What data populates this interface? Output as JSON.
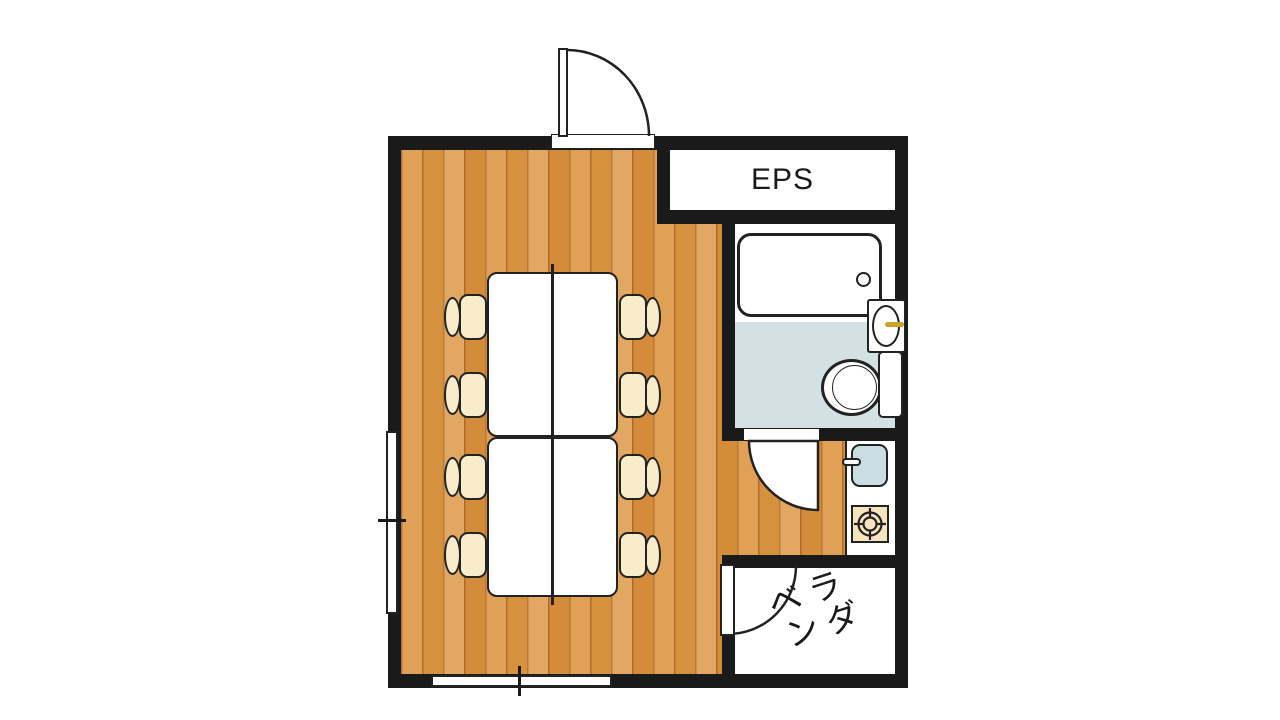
{
  "floorplan": {
    "title": "room-floor-plan",
    "labels": {
      "eps": "EPS",
      "veranda_line1": "ベラ",
      "veranda_line2": "ンダ"
    },
    "rooms": [
      {
        "name": "main-room",
        "floor": "wood"
      },
      {
        "name": "eps-shaft",
        "floor": "white"
      },
      {
        "name": "bathroom",
        "floor": "light-blue"
      },
      {
        "name": "kitchen-hallway",
        "floor": "wood"
      },
      {
        "name": "veranda",
        "floor": "white"
      }
    ],
    "furniture": [
      "meeting-table-2-sections",
      "chair x8",
      "bathtub",
      "washbasin",
      "toilet",
      "kitchen-sink",
      "stove-burner"
    ],
    "colors": {
      "wall": "#1a1a1a",
      "wood_base": "#dd9a4e",
      "wood_gap": "#c07c35",
      "bath_floor": "#d3e1e5",
      "chair_seat": "#f8ecca",
      "kitchen_sink": "#c9dde2",
      "stove_top": "#f7e3bd",
      "faucet_gold": "#c9a227",
      "fixture_outline": "#222222"
    }
  }
}
